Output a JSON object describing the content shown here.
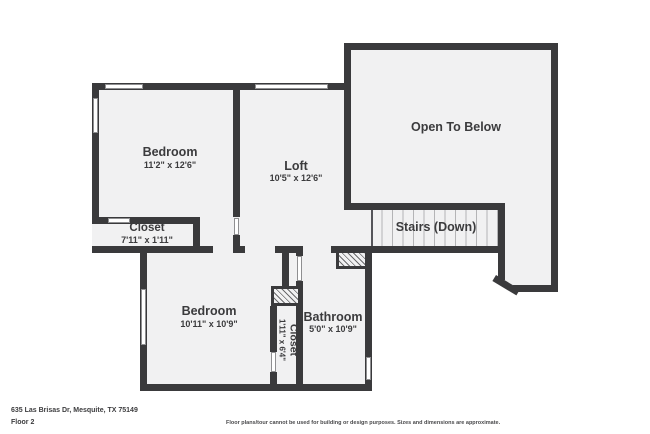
{
  "plan": {
    "address_line": "635 Las Brisas Dr, Mesquite, TX 75149",
    "floor_label": "Floor 2",
    "disclaimer": "Floor plans/tour cannot be used for building or design purposes. Sizes and dimensions are approximate.",
    "colors": {
      "wall": "#3a3a3c",
      "room_fill": "#f1f1f2",
      "text": "#3b3b3d"
    }
  },
  "rooms": {
    "bedroom1": {
      "name": "Bedroom",
      "dims": "11'2\" x 12'6\""
    },
    "loft": {
      "name": "Loft",
      "dims": "10'5\" x 12'6\""
    },
    "open_below": {
      "name": "Open To Below",
      "dims": ""
    },
    "closet1": {
      "name": "Closet",
      "dims": "7'11\" x 1'11\""
    },
    "stairs": {
      "name": "Stairs (Down)",
      "dims": ""
    },
    "bedroom2": {
      "name": "Bedroom",
      "dims": "10'11\" x 10'9\""
    },
    "closet2": {
      "name": "Closet",
      "dims": "1'11\" x 6'4\""
    },
    "bathroom": {
      "name": "Bathroom",
      "dims": "5'0\" x 10'9\""
    }
  }
}
